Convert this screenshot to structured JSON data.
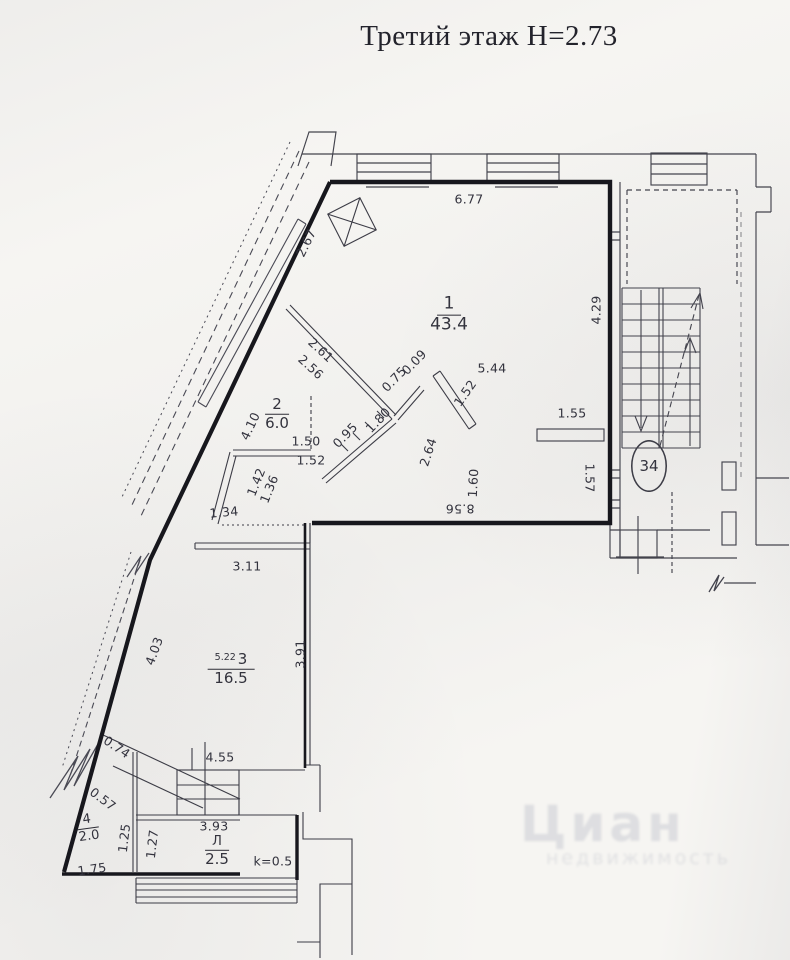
{
  "title": "Третий этаж Н=2.73",
  "apartment_number": "34",
  "colors": {
    "ink": "#3b3b45",
    "wall": "#17171d",
    "paper": "#f6f5f2"
  },
  "rooms": [
    {
      "number": "1",
      "area": "43.4"
    },
    {
      "number": "2",
      "area": "6.0"
    },
    {
      "number": "3",
      "area": "16.5",
      "side_dim": "5.22"
    },
    {
      "number": "4",
      "area": "2.0"
    },
    {
      "number": "Л",
      "area": "2.5",
      "coefficient": "k=0.5"
    }
  ],
  "dimensions": {
    "top_wall": "6.77",
    "diag_wall_upper": "2.67",
    "room1_right": "4.29",
    "room1_width": "5.44",
    "room1_diag": "1.52",
    "shelf": "1.55",
    "part12_outer": "2.61",
    "part12_inner": "2.56",
    "stub_outer": "0.75",
    "stub_inner": "0.09",
    "partb_upper": "1.80",
    "partb_lower": "0.95",
    "diag_wall_mid": "4.10",
    "partc_top": "1.50",
    "partc_bottom": "1.52",
    "small_diag_outer": "1.42",
    "small_diag_inner": "1.36",
    "niche": "1.34",
    "room1_inner_diag": "2.64",
    "room1_inner_vert": "1.60",
    "room1_bottom": "8.56",
    "right_wall_lower": "1.57",
    "step": "3.11",
    "diag_wall_lower": "4.03",
    "room3_right": "3.91",
    "room3_bottom": "4.55",
    "room4_outer": "0.74",
    "room4_inner": "0.57",
    "room4_left": "1.25",
    "room4_mid": "1.27",
    "room4_bottom": "1.75",
    "loggia_width": "3.93"
  },
  "watermark": {
    "line1": "Циан",
    "line2": "недвижимость"
  }
}
